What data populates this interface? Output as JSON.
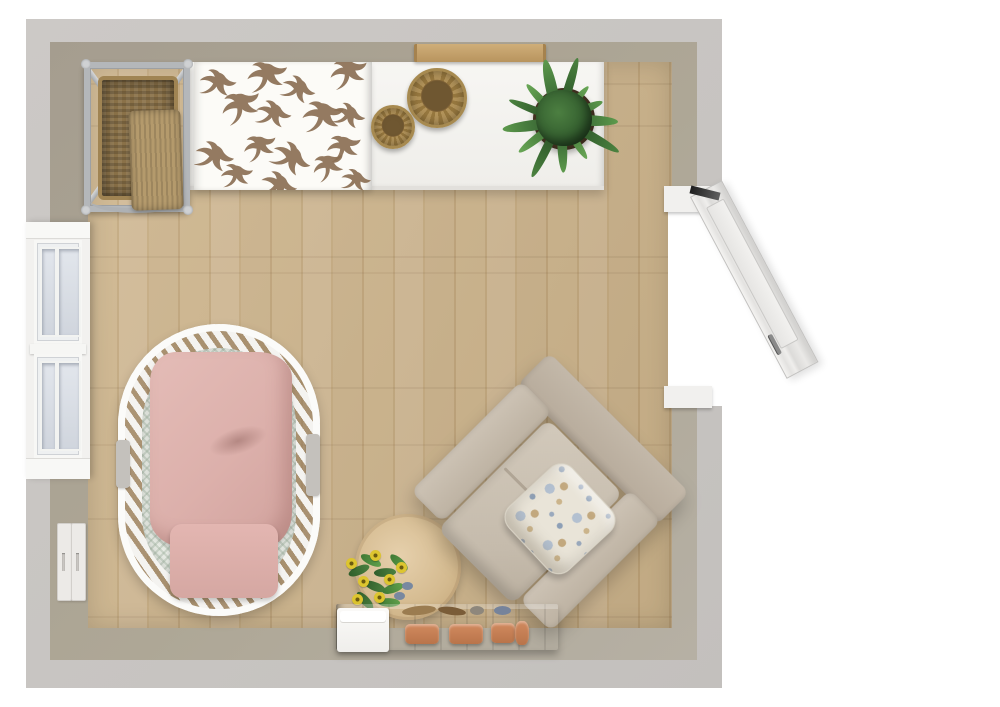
{
  "scene": {
    "title": "Nursery floor plan - 3D top view",
    "view": "top-down room render",
    "room_type": "nursery",
    "background_color": "#ffffff",
    "room": {
      "wall_outer_color": "#c7c4c1",
      "wall_inner_color": "#aea796",
      "floor_color": "#c9ae84",
      "floor_material": "light oak planks"
    },
    "accent_colors": {
      "crib_blanket_pink": "#dcb0ab",
      "armchair_beige": "#c5bbac",
      "plant_green": "#3f6b3b",
      "woven_basket_tan": "#b2935a",
      "bench_wood": "#b18d59",
      "terracotta": "#c8815a",
      "pillow_paisley_blue": "#8d9fb6",
      "door_white": "#e9e8e6"
    },
    "objects": [
      {
        "name": "double-hung-window"
      },
      {
        "name": "open-door"
      },
      {
        "name": "light-switch-pair"
      },
      {
        "name": "wicker-hamper-stand"
      },
      {
        "name": "changing-table-dresser"
      },
      {
        "name": "swallow-pattern-changing-mat"
      },
      {
        "name": "woven-basket-large"
      },
      {
        "name": "woven-basket-small"
      },
      {
        "name": "potted-plant"
      },
      {
        "name": "wall-shelf"
      },
      {
        "name": "oval-crib"
      },
      {
        "name": "crib-pink-blanket"
      },
      {
        "name": "crib-pink-pillow"
      },
      {
        "name": "upholstered-armchair"
      },
      {
        "name": "paisley-throw-pillow"
      },
      {
        "name": "teddy-bear"
      },
      {
        "name": "round-side-table"
      },
      {
        "name": "yellow-flower-bouquet"
      },
      {
        "name": "wooden-storage-bench"
      },
      {
        "name": "white-storage-box"
      },
      {
        "name": "terracotta-pots"
      }
    ]
  }
}
